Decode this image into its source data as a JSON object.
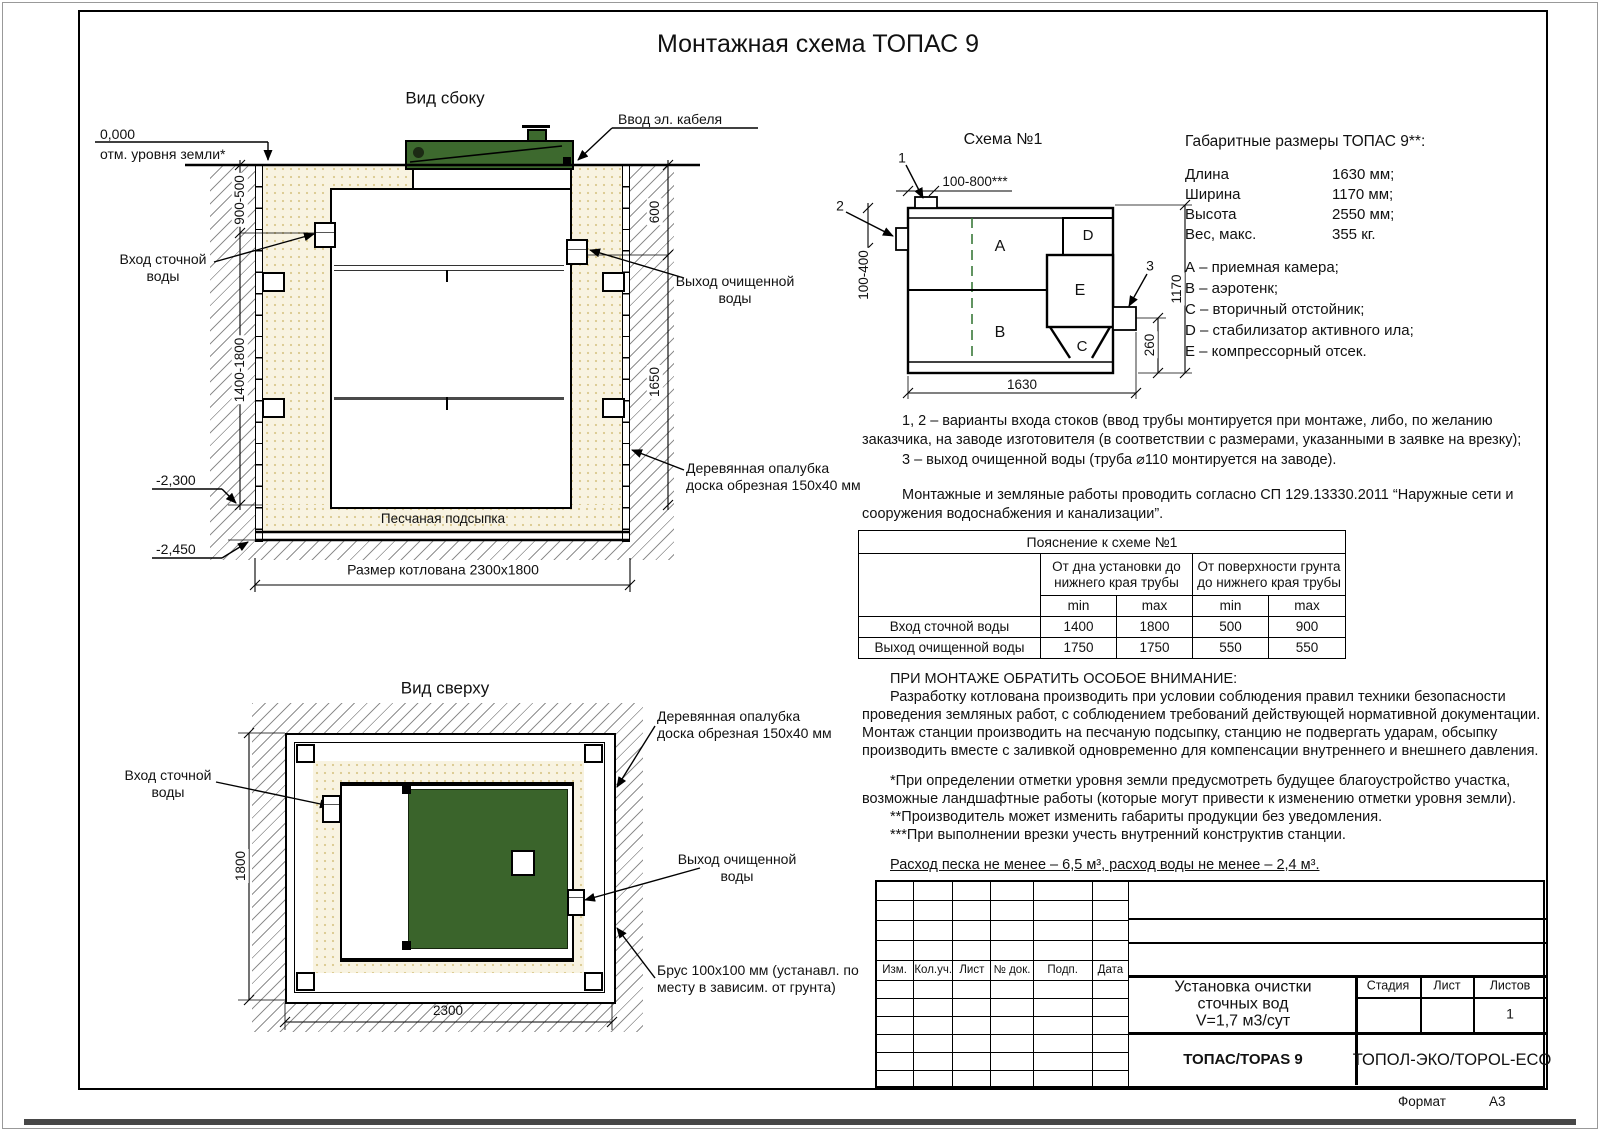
{
  "page": {
    "title": "Монтажная схема ТОПАС 9",
    "format_label": "Формат",
    "format_value": "А3"
  },
  "side_view": {
    "title": "Вид сбоку",
    "zero_mark": "0,000",
    "ground_note": "отм. уровня земли*",
    "cable_label": "Ввод эл. кабеля",
    "inlet_label": "Вход сточной\nводы",
    "outlet_label": "Выход очищенной\nводы",
    "formwork_label": "Деревянная опалубка\nдоска обрезная 150х40 мм",
    "sand_label": "Песчаная подсыпка",
    "pit_label": "Размер котлована 2300х1800",
    "dim_900_500": "900-500",
    "dim_1400_1800": "1400-1800",
    "dim_600": "600",
    "dim_1650": "1650",
    "mark_2300": "-2,300",
    "mark_2450": "-2,450"
  },
  "top_view": {
    "title": "Вид сверху",
    "inlet_label": "Вход сточной\nводы",
    "outlet_label": "Выход очищенной\nводы",
    "formwork_label": "Деревянная опалубка\nдоска обрезная 150х40 мм",
    "beam_label": "Брус 100х100 мм (устанавл. по\nместу в зависим. от грунта)",
    "dim_1800": "1800",
    "dim_2300": "2300"
  },
  "schema": {
    "title": "Схема №1",
    "callout_1": "1",
    "callout_2": "2",
    "callout_3": "3",
    "dim_top": "100-800***",
    "dim_left": "100-400",
    "dim_right": "1170",
    "dim_outlet": "260",
    "dim_bottom": "1630",
    "comp_a": "A",
    "comp_b": "B",
    "comp_c": "C",
    "comp_d": "D",
    "comp_e": "E"
  },
  "overall": {
    "title": "Габаритные размеры ТОПАС 9**:",
    "rows": [
      {
        "name": "Длина",
        "value": "1630 мм;"
      },
      {
        "name": "Ширина",
        "value": "1170 мм;"
      },
      {
        "name": "Высота",
        "value": "2550 мм;"
      },
      {
        "name": "Вес, макс.",
        "value": "355 кг."
      }
    ],
    "legend": [
      "А – приемная камера;",
      "В – аэротенк;",
      "С – вторичный отстойник;",
      "D – стабилизатор активного ила;",
      "Е – компрессорный отсек."
    ]
  },
  "notes": {
    "note12": "1, 2 – варианты входа  стоков (ввод трубы монтируется при монтаже, либо, по желанию заказчика, на заводе изготовителя (в соответствии с размерами, указанными в заявке на врезку);",
    "note3": "3 – выход очищенной воды (труба ⌀110 монтируется на заводе).",
    "sp": "Монтажные и земляные работы проводить согласно СП 129.13330.2011 “Наружные сети и сооружения водоснабжения и канализации”."
  },
  "table": {
    "title": "Пояснение к схеме №1",
    "group1": "От дна установки до нижнего края трубы",
    "group2": "От поверхности грунта до нижнего края трубы",
    "min_label": "min",
    "max_label": "max",
    "rows": [
      {
        "label": "Вход сточной воды",
        "v1": "1400",
        "v2": "1800",
        "v3": "500",
        "v4": "900"
      },
      {
        "label": "Выход очищенной воды",
        "v1": "1750",
        "v2": "1750",
        "v3": "550",
        "v4": "550"
      }
    ]
  },
  "attention": {
    "heading": "ПРИ МОНТАЖЕ ОБРАТИТЬ ОСОБОЕ ВНИМАНИЕ:",
    "p1": "Разработку котлована производить при условии соблюдения правил техники безопасности проведения земляных работ, с соблюдением требований действующей нормативной документации. Монтаж станции производить на песчаную подсыпку, станцию не подвергать ударам, обсыпку производить вместе с заливкой одновременно для компенсации внутреннего и внешнего давления.",
    "star1": "*При определении отметки уровня земли предусмотреть будущее благоустройство участка, возможные ландшафтные работы (которые могут привести к изменению отметки уровня земли).",
    "star2": "**Производитель может изменить габариты продукции без уведомления.",
    "star3": "***При выполнении врезки учесть внутренний конструктив станции.",
    "consumption": "Расход песка не менее – 6,5 м³, расход воды не менее – 2,4 м³."
  },
  "title_block": {
    "rev_headers": [
      "Изм.",
      "Кол.уч.",
      "Лист",
      "№ док.",
      "Подп.",
      "Дата"
    ],
    "doc_title": "Установка очистки\nсточных вод\nV=1,7 м3/сут",
    "product": "ТОПАС/TOPAS 9",
    "stage_label": "Стадия",
    "sheet_label": "Лист",
    "sheets_label": "Листов",
    "sheets_value": "1",
    "company": "ТОПОЛ-ЭКО/TOPOL-ECO"
  },
  "colors": {
    "lid_green": "#3d692e",
    "top_green": "#3a642b",
    "sand_fill": "#f8f3e1",
    "hatch_line": "#8f8f8f"
  }
}
